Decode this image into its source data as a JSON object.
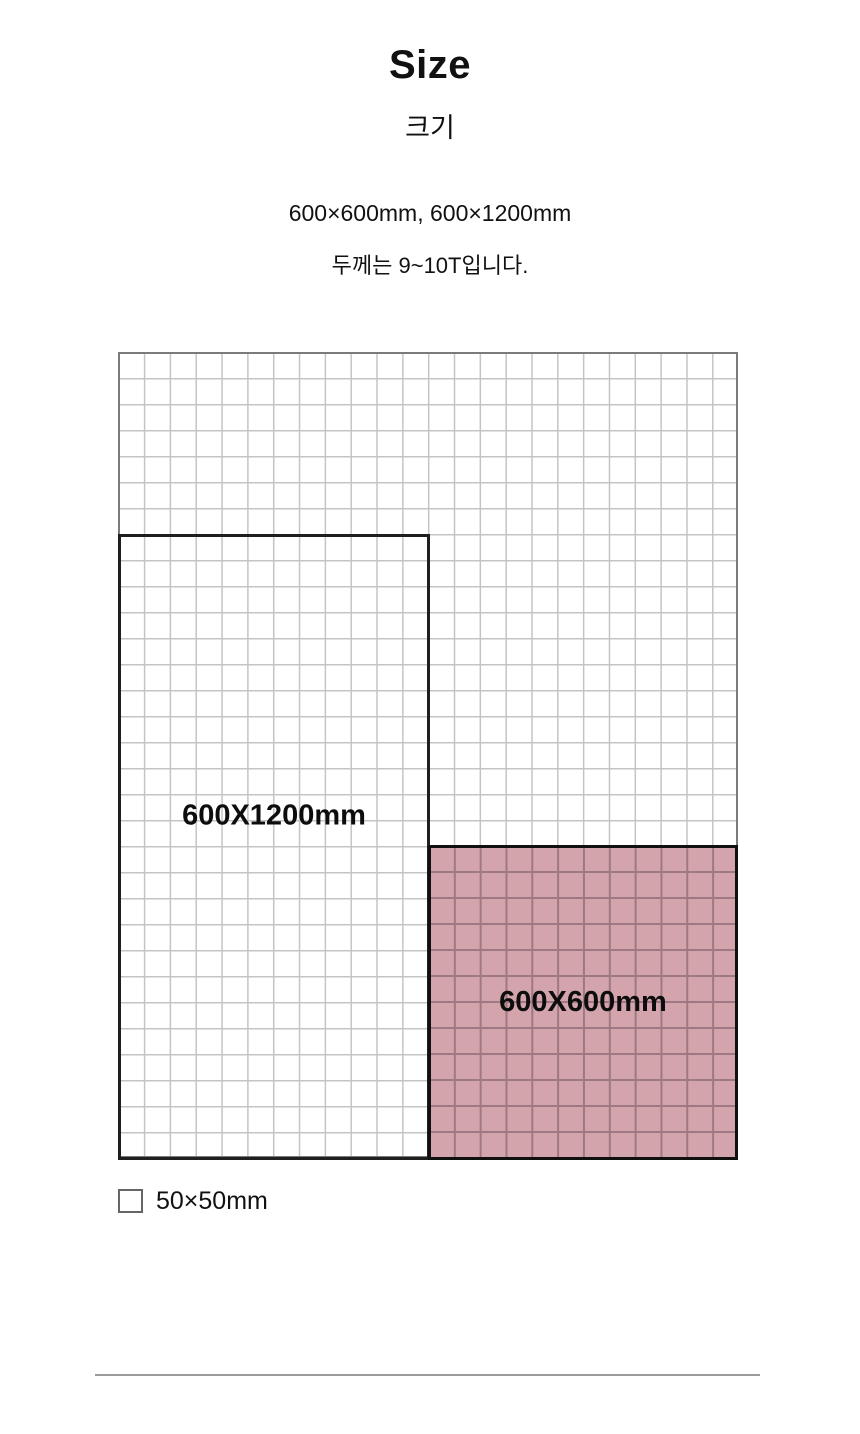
{
  "header": {
    "title": "Size",
    "subtitle": "크기",
    "sizes_line": "600×600mm, 600×1200mm",
    "thickness_line": "두께는 9~10T입니다."
  },
  "diagram": {
    "grid": {
      "columns": 24,
      "rows": 31,
      "cell_size_mm": "50×50mm",
      "line_color": "#c4c4c4",
      "border_color": "#7b7b7b"
    },
    "panels": [
      {
        "label": "600X1200mm",
        "width_mm": 600,
        "height_mm": 1200,
        "fill": "none",
        "border_color": "#1f1f1f"
      },
      {
        "label": "600X600mm",
        "width_mm": 600,
        "height_mm": 600,
        "fill": "#d4a4ad",
        "grid_line_color": "#9e7882",
        "border_color": "#101010"
      }
    ]
  },
  "legend": {
    "label": "50×50mm"
  },
  "colors": {
    "background": "#ffffff",
    "text": "#111111",
    "divider": "#9b9b9b"
  }
}
